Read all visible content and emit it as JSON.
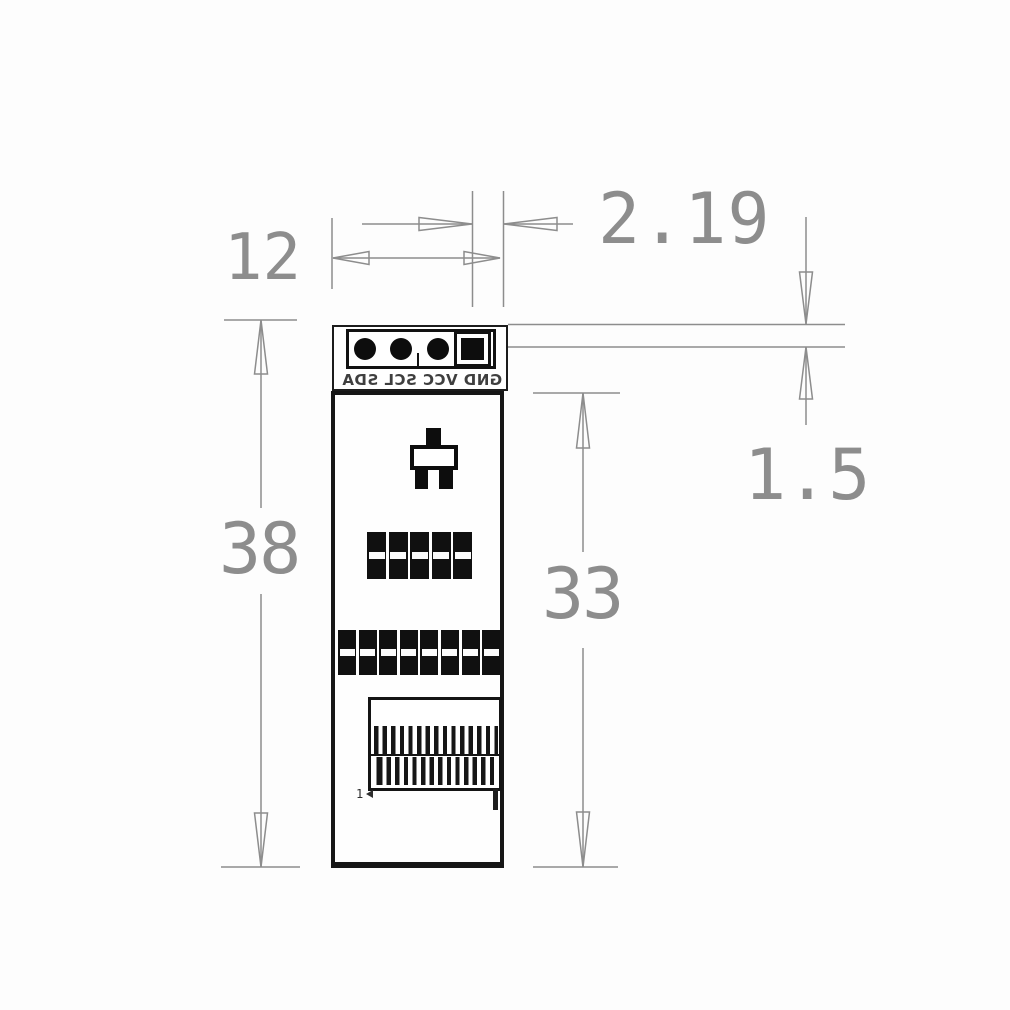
{
  "dimensions": {
    "board_width": "12",
    "pin_edge_offset": "2.19",
    "overall_height": "38",
    "body_height": "33",
    "pin_row_thickness": "1.5"
  },
  "board": {
    "pin_labels_mirrored": "GND VCC SCL SDA",
    "pin1_marker": "1"
  },
  "colors": {
    "dimension_gray": "#8d8d8d",
    "board_ink": "#141414",
    "background": "#fdfdfd"
  }
}
